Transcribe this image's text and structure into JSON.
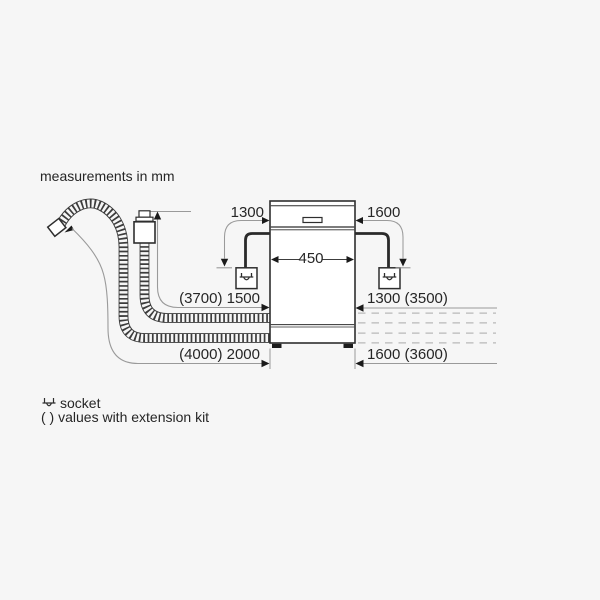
{
  "title": "measurements in mm",
  "dimensions": {
    "socket_left": "1300",
    "socket_right": "1600",
    "appliance_width": "450",
    "supply_hose_left": "(3700) 1500",
    "supply_hose_right": "1300 (3500)",
    "drain_hose_left": "(4000) 2000",
    "drain_hose_right": "1600 (3600)"
  },
  "legend": {
    "socket_label": "socket",
    "extension_note": "( ) values with extension kit"
  },
  "colors": {
    "background": "#f6f6f6",
    "ink": "#2e2e2e",
    "hose": "#3c3c3c",
    "dimension_line": "#9a9a9a",
    "dashed_extension": "#b8b8b8",
    "arrow": "#1a1a1a",
    "text": "#262626"
  }
}
